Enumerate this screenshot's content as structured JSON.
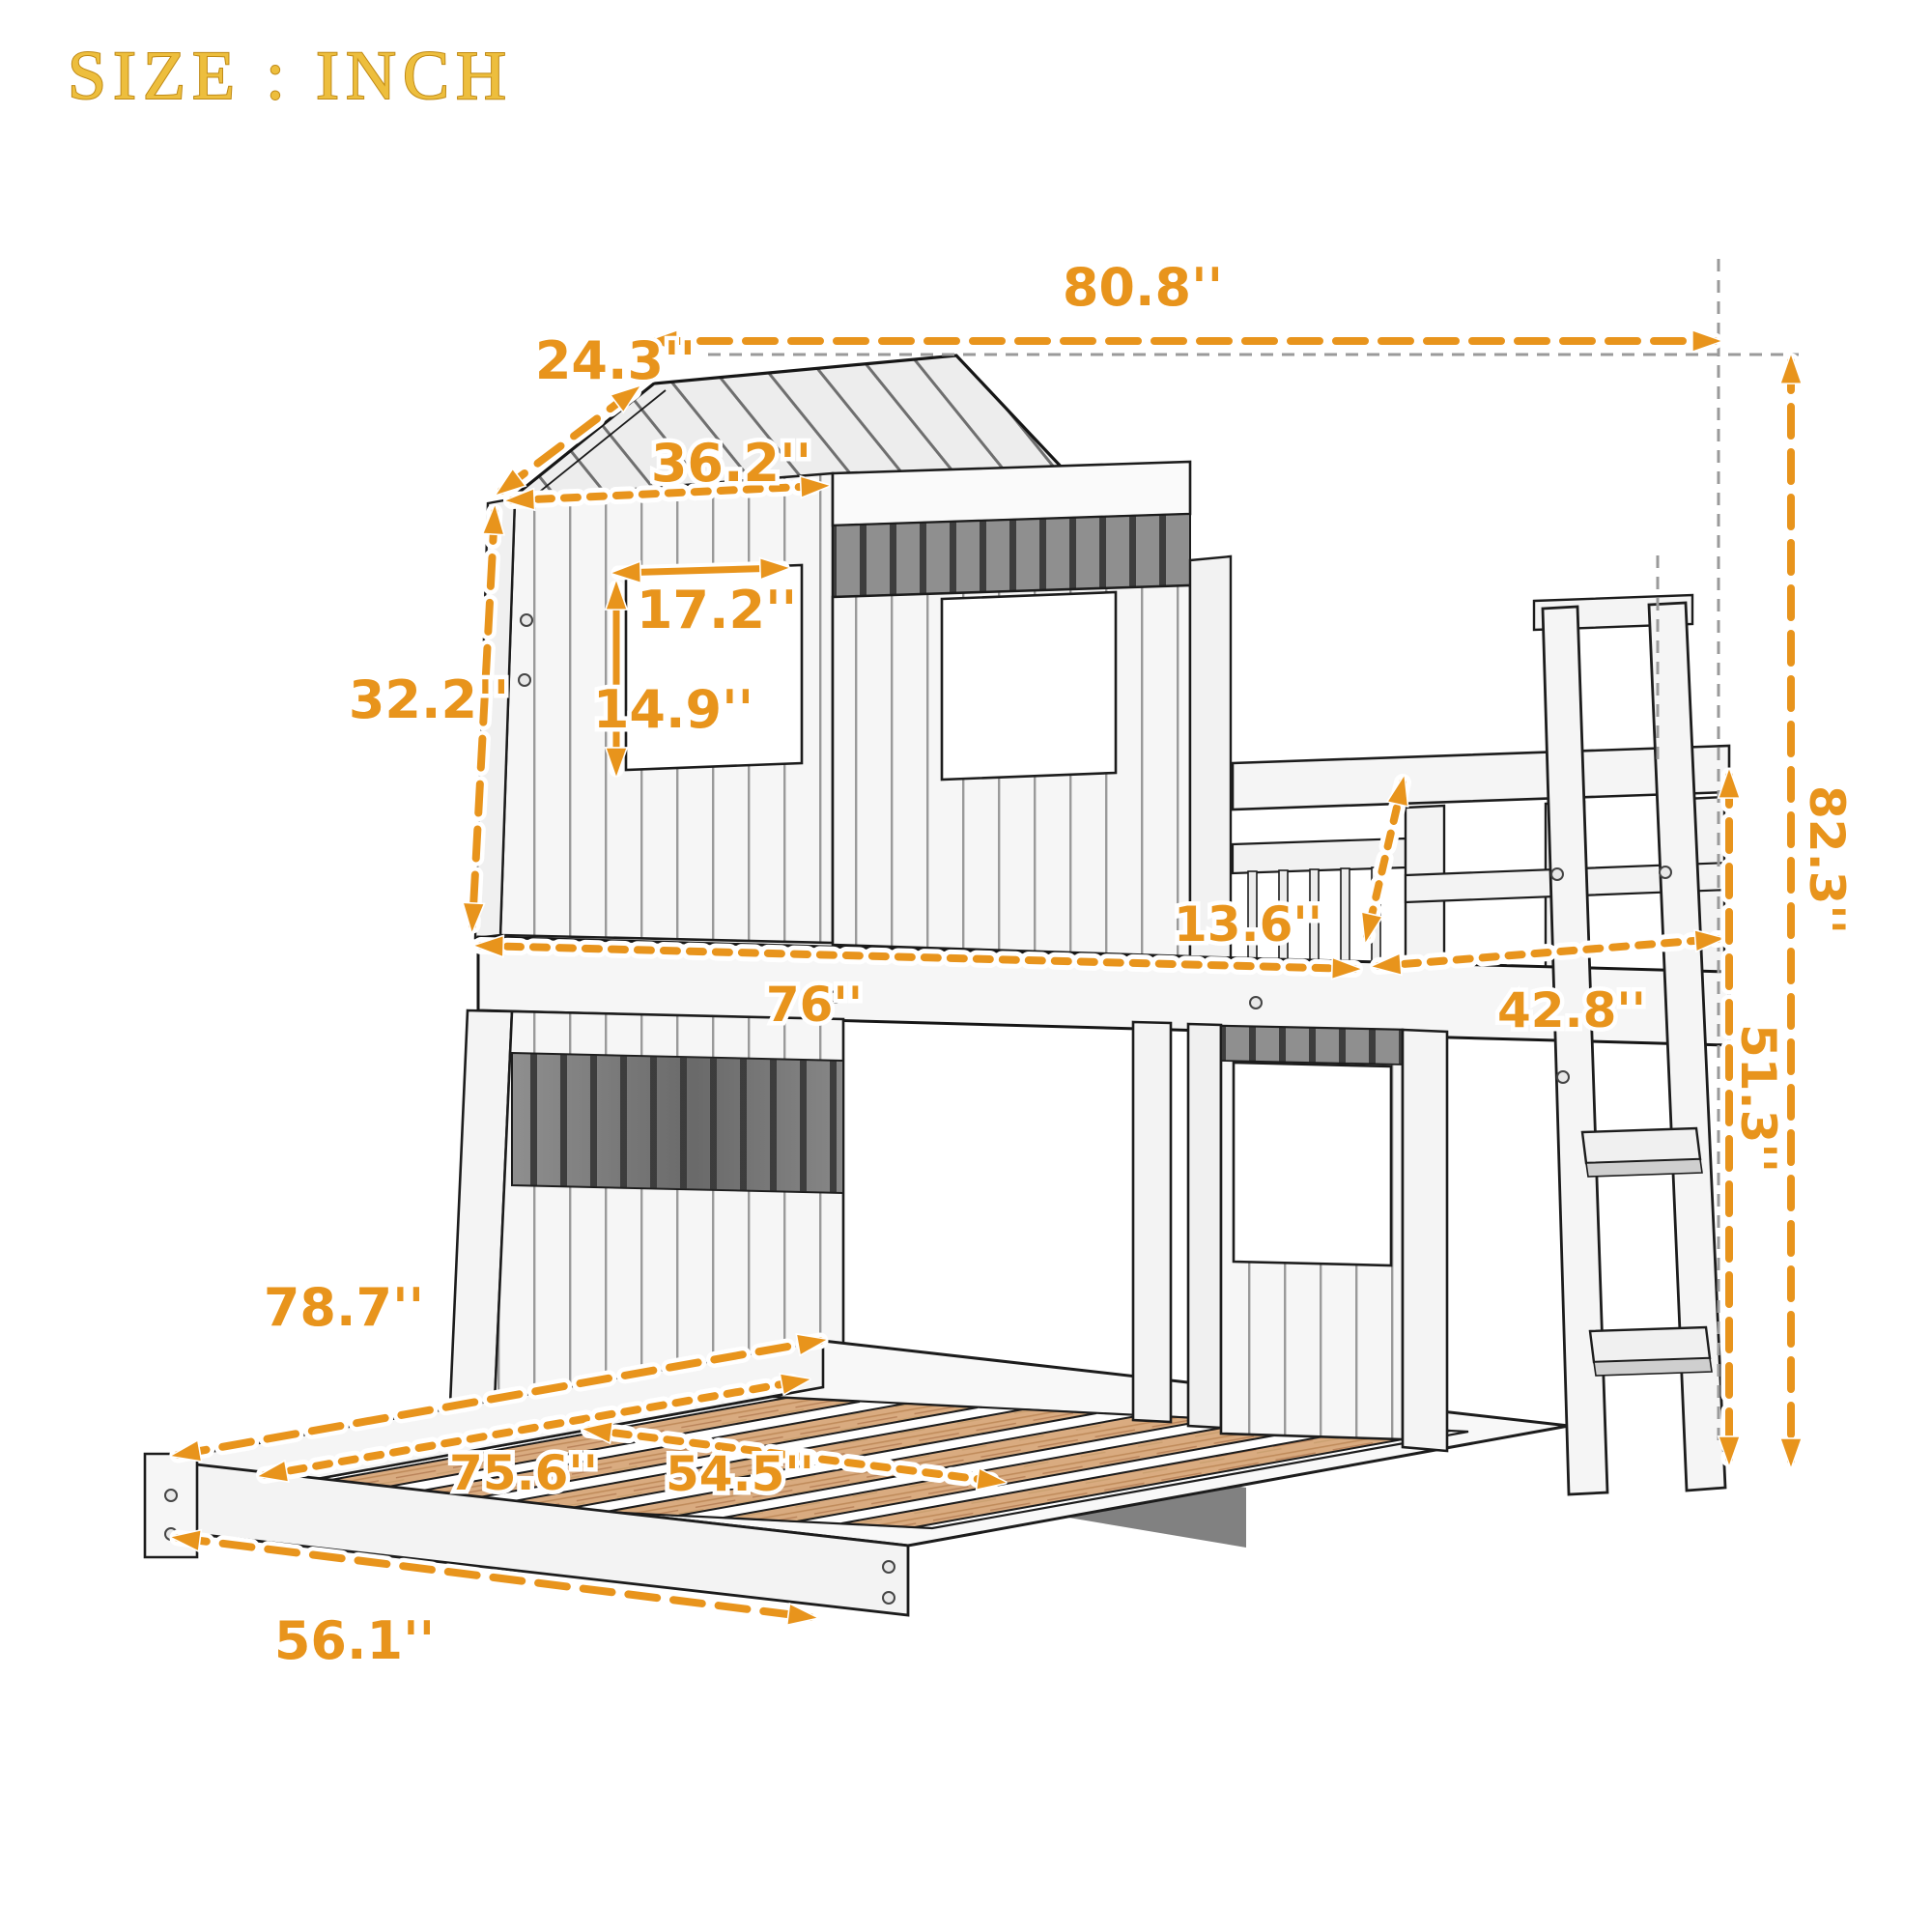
{
  "title": "SIZE : INCH",
  "unit": "INCH",
  "diagram": {
    "type": "product-dimension-diagram",
    "product": "playhouse bunk bed with ladder over pull-out bed",
    "colors": {
      "dimension_orange": "#E8941C",
      "title_gold": "#EDBE3D",
      "wood_slat": "#D9AB80",
      "line_art": "#1c1c1c",
      "guide_gray": "#9a9a9a"
    },
    "labels": {
      "overall_length": "80.8''",
      "roof_slope": "24.3''",
      "roof_edge": "36.2''",
      "window_width": "17.2''",
      "window_height": "14.9''",
      "upper_house_height": "32.2''",
      "railing_height": "13.6''",
      "bunk_length": "76''",
      "ladder_section": "42.8''",
      "total_height": "82.3''",
      "under_loft_height": "51.3''",
      "bed_outer_length": "78.7''",
      "bed_inner_length": "75.6''",
      "bed_inner_width": "54.5''",
      "bed_outer_width": "56.1''"
    }
  }
}
